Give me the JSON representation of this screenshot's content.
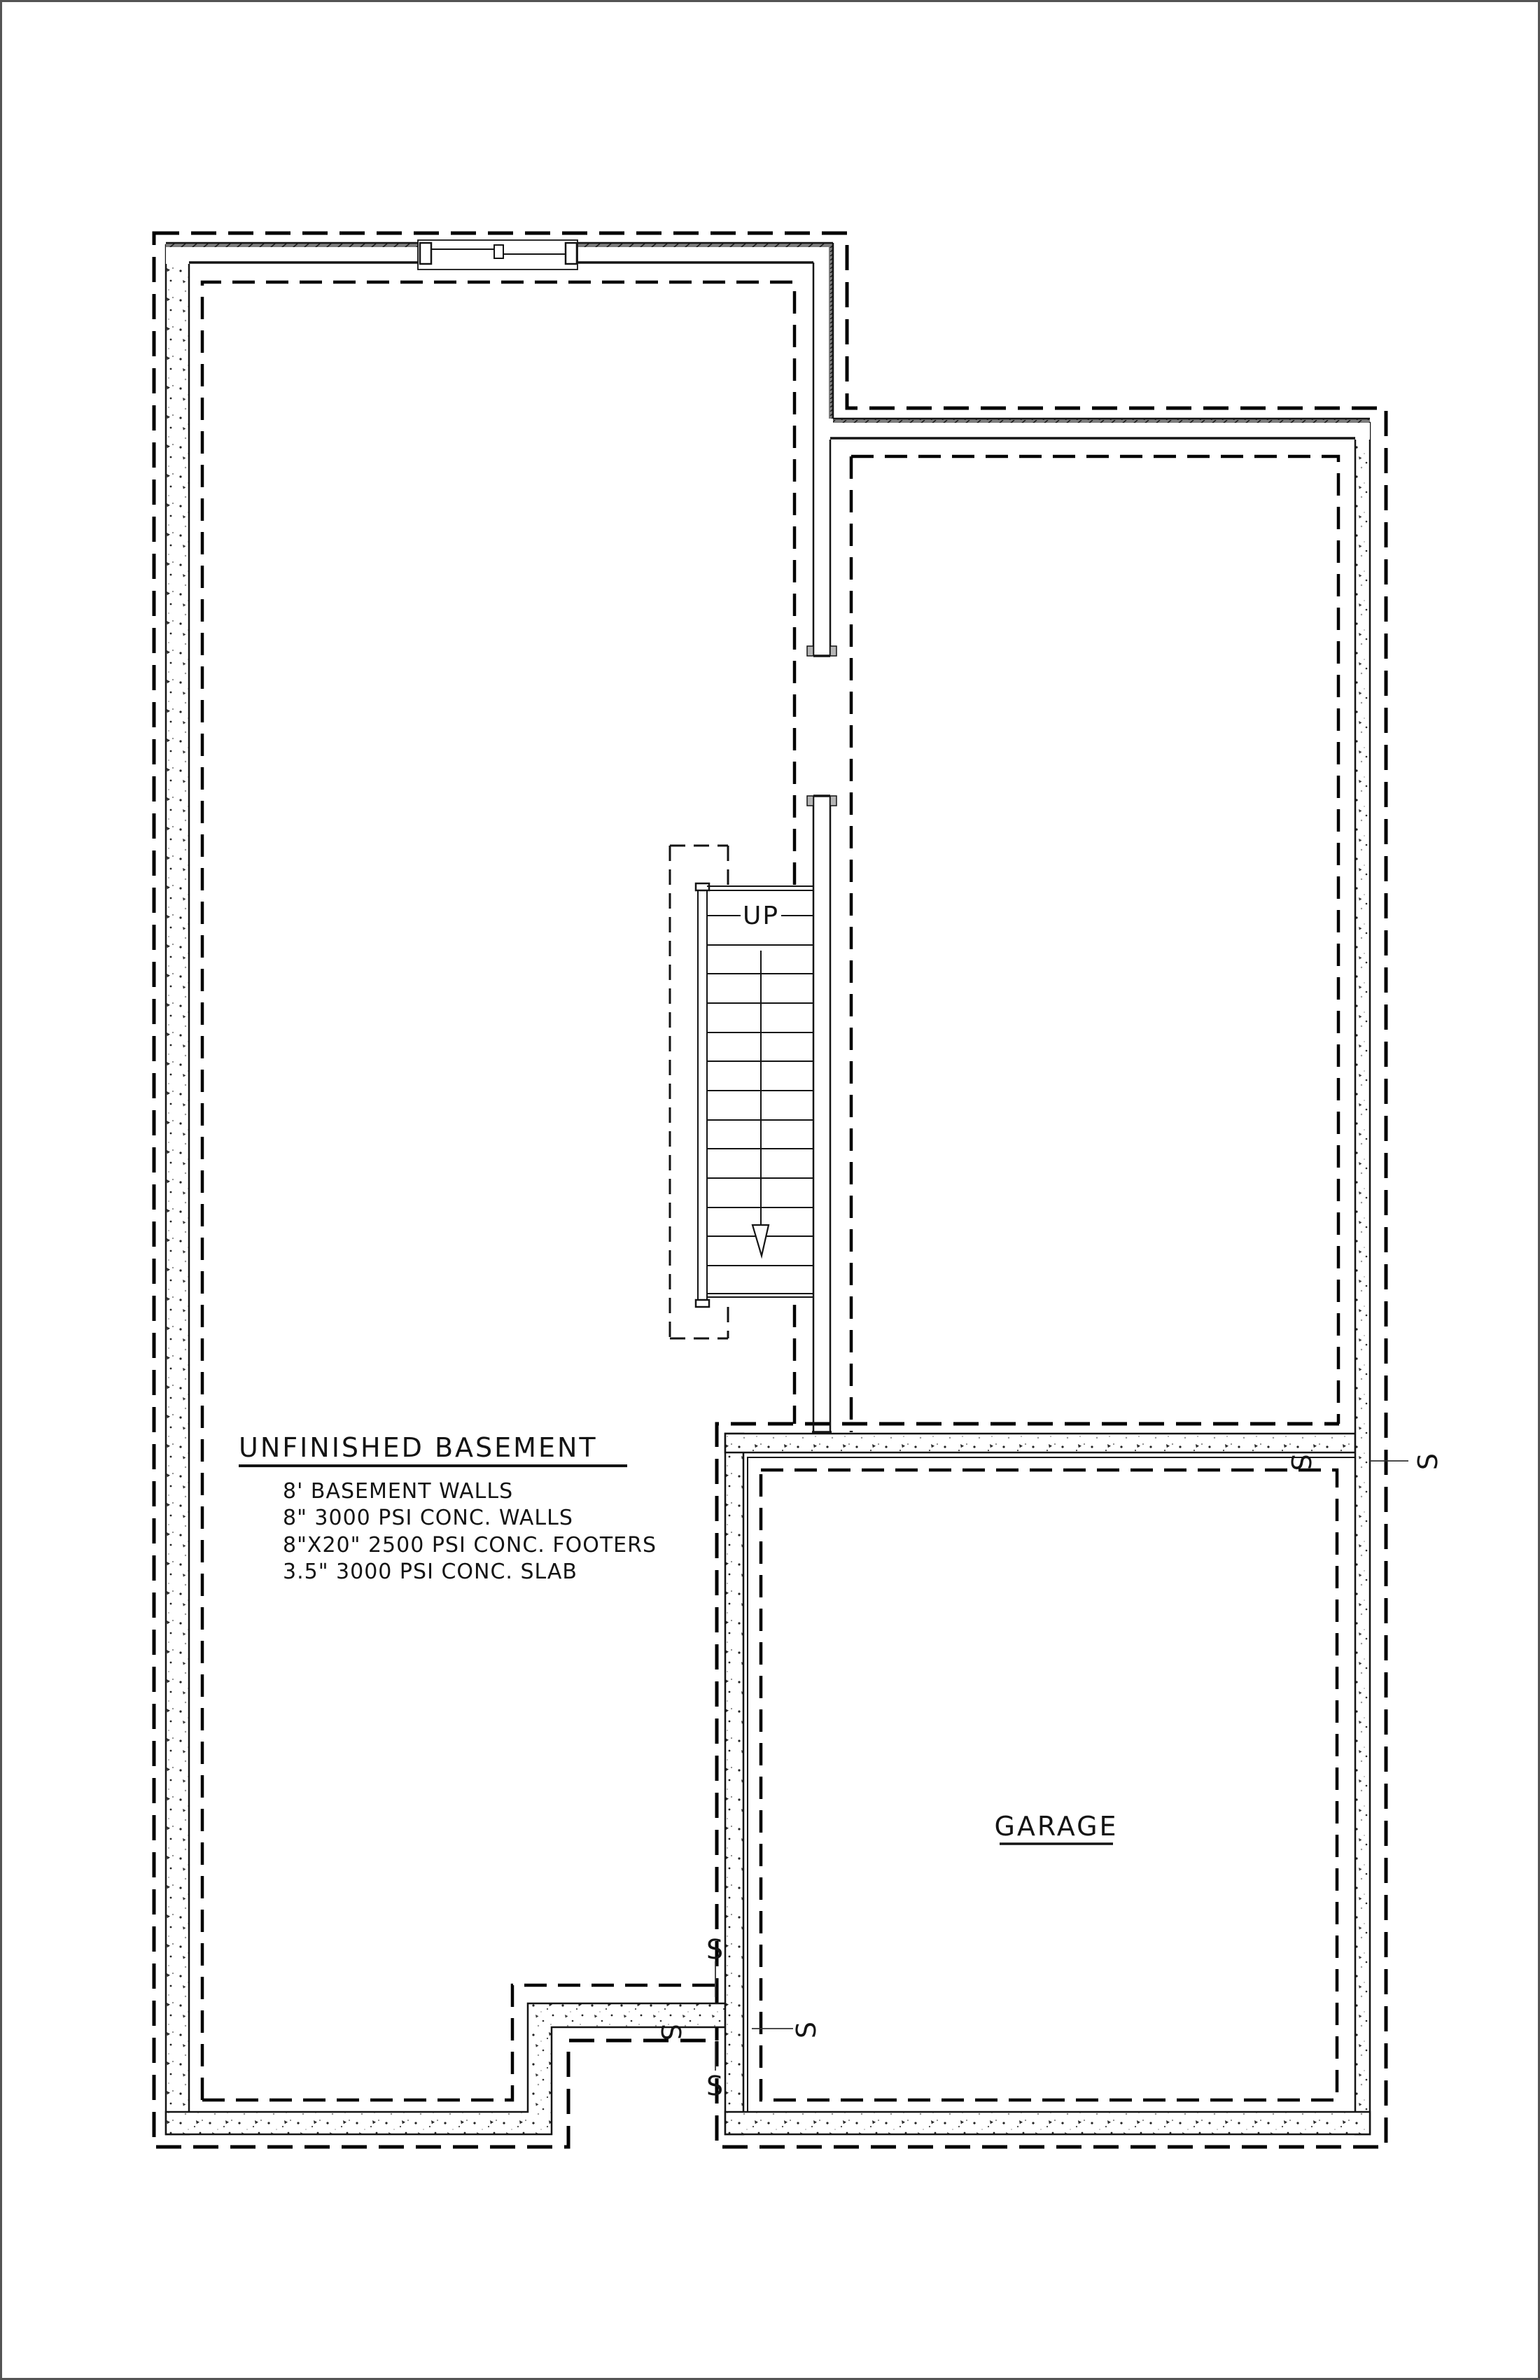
{
  "drawing": {
    "room_labels": {
      "basement": "UNFINISHED BASEMENT",
      "garage": "GARAGE",
      "stair_direction": "UP"
    },
    "notes": [
      "8' BASEMENT WALLS",
      "8\" 3000 PSI CONC. WALLS",
      "8\"X20\" 2500 PSI CONC. FOOTERS",
      "3.5\" 3000 PSI CONC. SLAB"
    ],
    "switch_symbol": "S",
    "colors": {
      "ink": "#141414",
      "paper": "#ffffff",
      "hatch_band": "#7d7d7d",
      "page_border": "#555555"
    }
  }
}
